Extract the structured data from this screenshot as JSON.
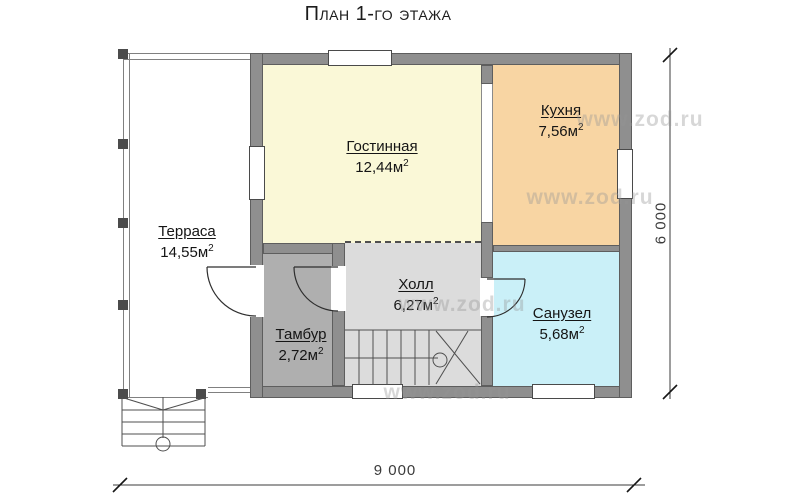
{
  "title": "План 1-го этажа",
  "watermark": "www.zod.ru",
  "rooms": [
    {
      "id": "terrace",
      "name": "Терраса",
      "area": "14,55м",
      "area_sup": "2"
    },
    {
      "id": "living",
      "name": "Гостинная",
      "area": "12,44м",
      "area_sup": "2"
    },
    {
      "id": "kitchen",
      "name": "Кухня",
      "area": "7,56м",
      "area_sup": "2"
    },
    {
      "id": "hall",
      "name": "Холл",
      "area": "6,27м",
      "area_sup": "2"
    },
    {
      "id": "tambour",
      "name": "Тамбур",
      "area": "2,72м",
      "area_sup": "2"
    },
    {
      "id": "bathroom",
      "name": "Санузел",
      "area": "5,68м",
      "area_sup": "2"
    }
  ],
  "dimensions": {
    "width_mm": "9 000",
    "height_mm": "6 000"
  },
  "colors": {
    "living_fill": "#FAF8D7",
    "kitchen_fill": "#F8D5A3",
    "bathroom_fill": "#CAF0F8",
    "hall_fill": "#DCDCDC",
    "tambour_fill": "#AFAFAF",
    "wall_fill": "#8F8F8F"
  }
}
